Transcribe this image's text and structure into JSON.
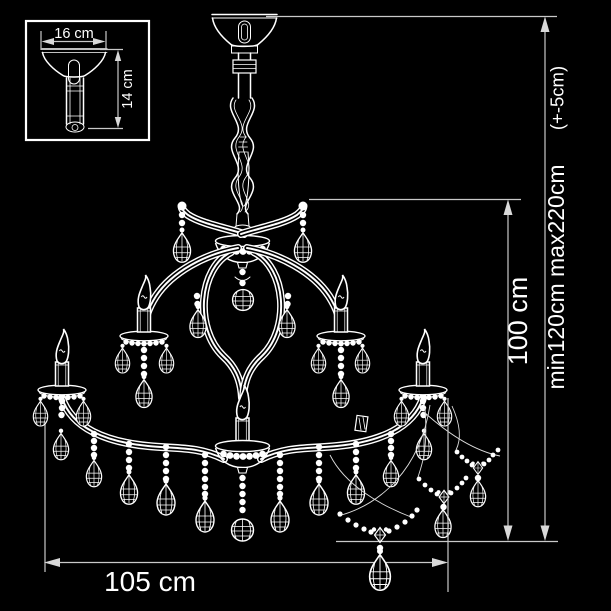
{
  "colors": {
    "background": "#000000",
    "line": "#ffffff",
    "dimension_line": "#c9c9c9"
  },
  "inset_detail": {
    "width_label": "16 cm",
    "height_label": "14 cm"
  },
  "main_dimensions": {
    "overall_width_label": "105 cm",
    "body_height_label": "100 cm",
    "suspension_height_label": "min120cm max220cm",
    "tolerance_label": "(+-5cm)"
  }
}
